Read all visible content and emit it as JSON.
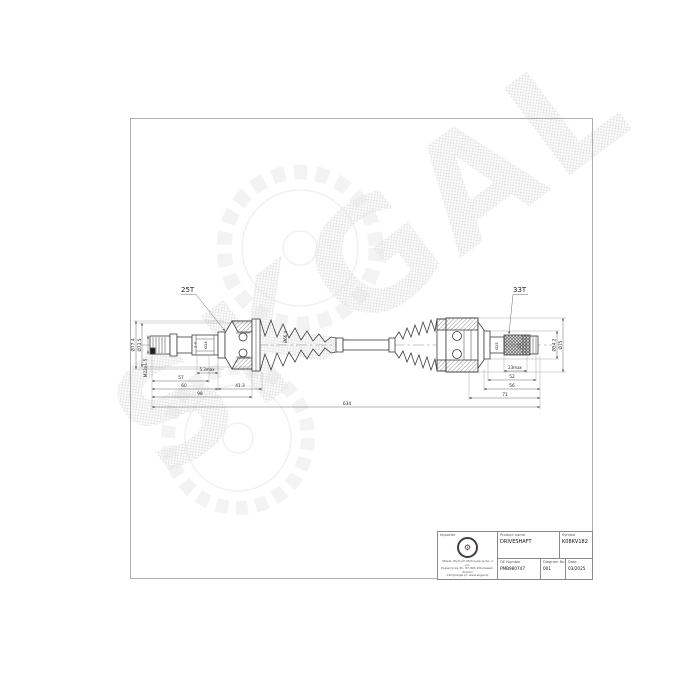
{
  "watermark": {
    "text": "SKGAL"
  },
  "colors": {
    "line": "#3d3d3d",
    "dim": "#5a5a5a",
    "watermark": "#e9e9e9",
    "frame": "#adadad"
  },
  "drawing": {
    "callout_left": "25T",
    "callout_right": "33T",
    "dim_od_outer": "Ø77.4",
    "dim_od_boot": "Ø73.5",
    "dim_thread": "M22x1.5",
    "dim_boot2": "Ø66.4",
    "dim_gap": "5.3max",
    "dim_57": "57",
    "dim_60": "60",
    "dim_413": "41.3",
    "dim_98": "98",
    "dim_total": "634",
    "dim_23": "23max",
    "dim_52": "52",
    "dim_56": "56",
    "dim_71": "71",
    "dim_od_inner": "Ø54.2",
    "dim_od_housing": "Ø75",
    "spline_l_a": "2-3",
    "spline_l_b": "Ø24",
    "spline_r_a": "Ø25",
    "spline_r_b": "2-3"
  },
  "title_block": {
    "importer_label": "Importer",
    "company_line1": "SKGAL Wytrych Motoryzacja Sp. z o.o.",
    "company_line2": "Papiernicza 3C, 87-800 Włocławek, Poland",
    "company_line3": "info@skgal.pl, www.skgal.pl",
    "product_label": "Product name",
    "product_value": "DRIVESHAFT",
    "symbol_label": "Symbol",
    "symbol_value": "K08KV182",
    "oe_label": "OE Number",
    "oe_value": "PMB980747",
    "diagram_label": "Diagram No",
    "diagram_value": "001",
    "date_label": "Date",
    "date_value": "03/2025"
  }
}
